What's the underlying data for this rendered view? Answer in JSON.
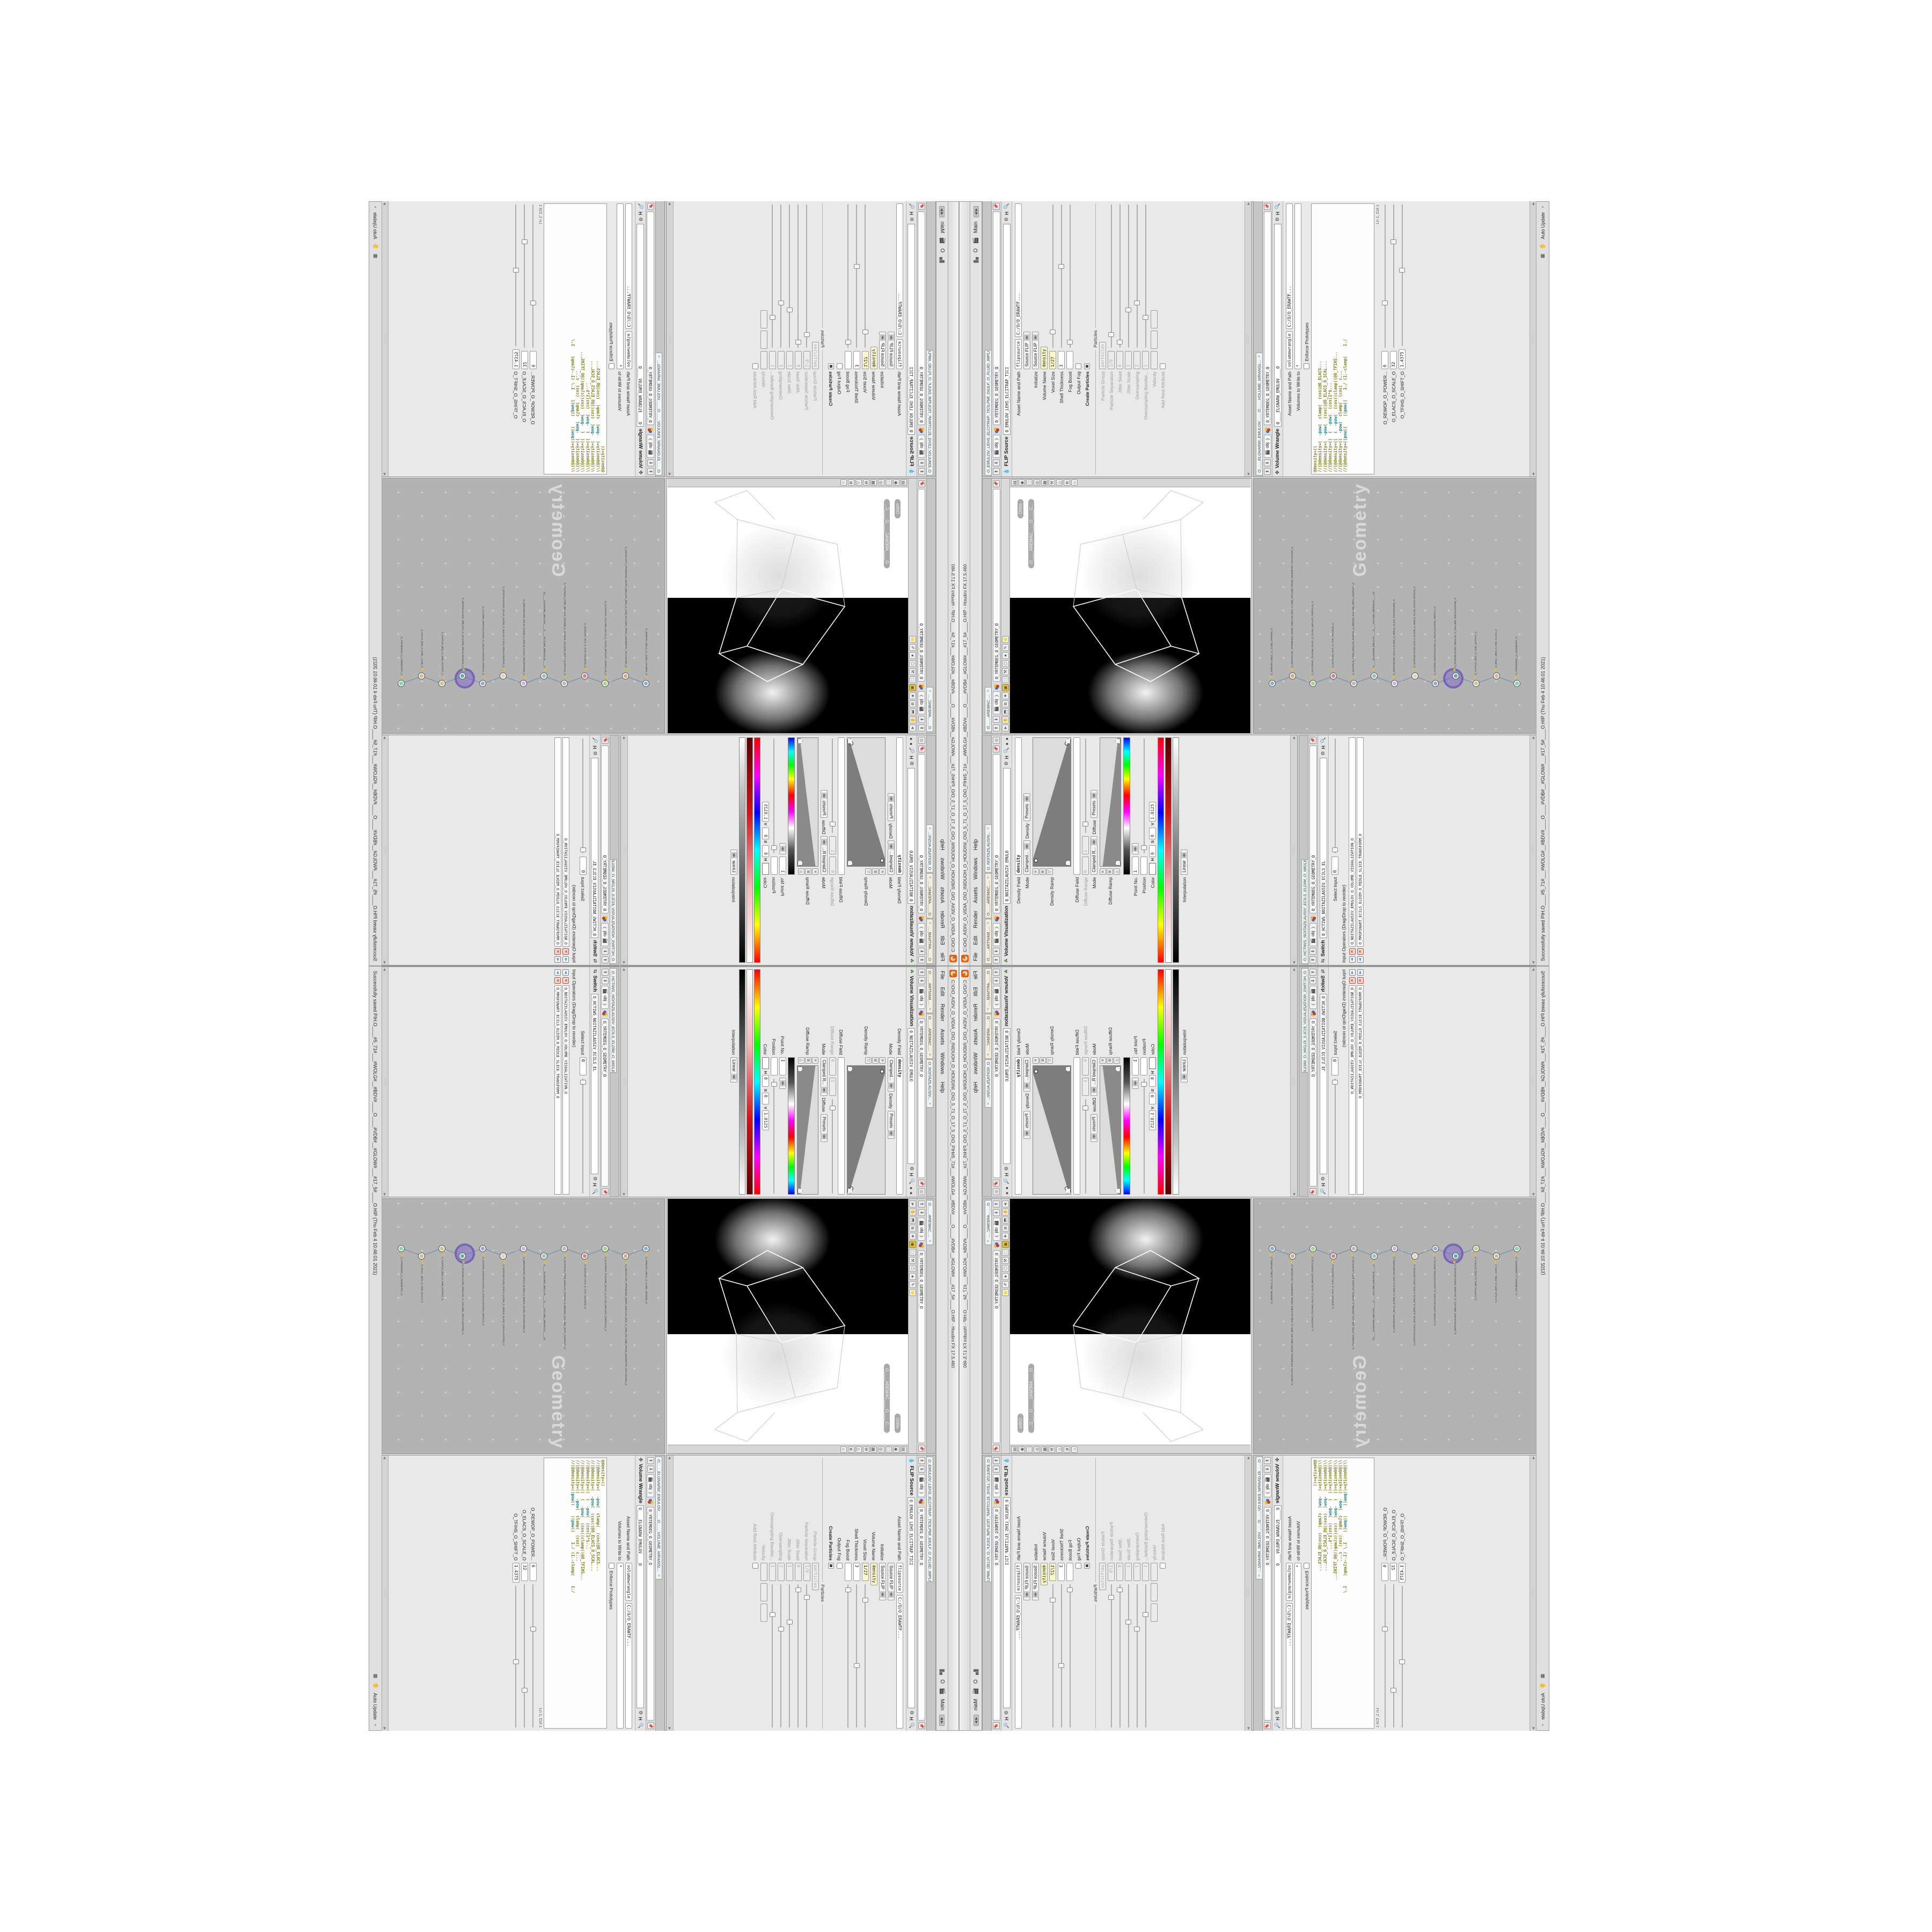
{
  "window": {
    "title": "C:\\O\\O_AIDIV_O_VIDIA_O\\O_INIDUOH_O_HOUDINI_O\\O_5_71_O_17_5_O\\O_PIH#5_71#___#WOLG#__#BDV#____O____#VDB#__#GLOW#___#17_5#____O.HIP - Houdini FX 17.5.460",
    "menus": [
      "File",
      "Edit",
      "Render",
      "Assets",
      "Windows",
      "Help"
    ],
    "menu_right_letter": "O",
    "desktop_name": "Main",
    "status_text": "Successfully saved PIH.O____#5_71#___#WOLG#__#BDV#____O____#VDB#__#GLOW#___#17_5#____O.HIP (Thu Feb 4 10:46:01 2021)",
    "auto_update_label": "Auto Update"
  },
  "colors": {
    "houdini_orange": "#e85d04",
    "selected_field_yellow": "#fbf6c8",
    "network_bg": "#b3b3b3",
    "halo_purple": "#826ec8",
    "wire_blue": "#7b93ad"
  },
  "pathbar": {
    "context": "obj",
    "node_path": "O_YRTEMOEG_O_GEOMETRY_O"
  },
  "volviz": {
    "tabs": [
      "O____ARTNAM_...",
      "O____AREMAC_...",
      "O_NOITAZILAUSIV..."
    ],
    "type": "Volume Visualization",
    "name": "O_NOITAZILAUSIV_EMULO",
    "density_field_label": "Density Field",
    "density_field_value": "density",
    "mode_label": "Mode",
    "mode_value": "Clamped...",
    "mode_mid": "Density",
    "presets_label": "Presets",
    "density_ramp_label": "Density Ramp",
    "diffuse_field_label": "Diffuse Field",
    "diffuse_range_label": "Diffuse Range",
    "diffuse_range_min": "0",
    "diffuse_range_max": "1",
    "mode2_value": "Clamped R...",
    "mode2_mid": "Diffuse",
    "diffuse_ramp_label": "Diffuse Ramp",
    "point_no_label": "Point No.",
    "point_no_value": "1",
    "position_label": "Position",
    "position_value": "",
    "color_label": "Color",
    "hsv_labels": [
      "H",
      "S",
      "V"
    ],
    "h_value": "0",
    "s_value": "0",
    "v_value": "1.8125",
    "interpolation_label": "Interpolation",
    "interpolation_value": "Linear"
  },
  "switch": {
    "tab": "O_HCTIWS_NOITAZILAUSIV_ECILS_ELDIM_O_MIDLE_SLICE_VISUAL...",
    "type": "Switch",
    "name": "O_HCTIWS_NOITAZILAUSIV_ECILS_EL",
    "select_input_label": "Select Input",
    "select_input_value": "0",
    "ops_label": "Input Operators (Drag/Drop to reorder)",
    "ops": [
      "O_NOITAZILAUSIV_EMULOV_O_VOLUME_VISUALIZATION_O",
      "O_MROFSNART_ECILS_ELDIM_O_MIDLE_SLICE_TRANSFORM_O"
    ]
  },
  "viewport": {
    "tab": "O____AREMAC_...",
    "cam_pill": "Ortho",
    "cam_pill2": "O____AREMAC____O____C...",
    "top_icons": [
      "➤",
      "✋",
      "⬒",
      "⧉",
      "✷",
      "▣",
      "⬚",
      "⚒",
      "⬡",
      "●",
      "✎",
      "⭐"
    ],
    "side_icons": [
      "▤",
      "◉",
      "⬚",
      "◎",
      "▦",
      "⚒",
      "△",
      "⧉",
      "○"
    ]
  },
  "network": {
    "watermark": "Geometry",
    "nodes": [
      {
        "label": "O_EREHPS_EBUC_O_CUBE_SPHERE_O",
        "c": "#7fb2d8"
      },
      {
        "label": "O_SNOGYLOP_YRTEMOEG_MORF_EMULOV_BDV_O_VDB_VOLUME_FROM_GEOMETRY_POLYGONS_O",
        "c": "#d8a87f"
      },
      {
        "label": "O_ELCITRAP_TICILPMI_DIULF_O_FLUID_IMPLICIT_PARTICLE_O",
        "c": "#9fd87f"
      },
      {
        "label": "O_ECRUOS_PILF_O_FLIP_SOURCE_O",
        "c": "#d87f7f"
      },
      {
        "label": "O_ECAFRUS_HTIW_EMULOV_EGREM_O_MERGE_VOLUME_WITH_SURFACE_O",
        "c": "#b8b8b8"
      },
      {
        "label": "O____ELGNARW_EMULOV____O____VOLUME_WRANGLE____O2",
        "c": "#88c7c0"
      },
      {
        "label": "O_MROFSNART_ECILS_ELDIM_O_MIDLE_SLICE_TRANSFORM_O",
        "c": "#c9b4e0"
      },
      {
        "label": "O_NOITAZILAUSIV_ECILS_ELDIM_O_MIDLE_SLICE_VISUALIZATION_O",
        "c": "#e0d4b4"
      },
      {
        "label": "O_HCTIWS_NOITAZILAUSIV_O_VISUALIZATION_SWITCH_O",
        "c": "#9aa8d0"
      },
      {
        "label": "O_NOITAZILAUSIV_EMULOV_O_VOLUME_VISUALIZATION_O",
        "c": "#53b8a4",
        "halo": true
      },
      {
        "label": "O_TUPTUO_BDV_O_VDB_OUTPUT_O",
        "c": "#caca7e"
      },
      {
        "label": "O_WOLG_BDV_O_VDB_GLOW_O",
        "c": "#e0b67f"
      },
      {
        "label": "O_YRTEMOEG_O_GEOMETRY_O",
        "c": "#7fd8a8"
      }
    ]
  },
  "flip": {
    "tab": "O_EMULOV_LEHS_ELCITRAP_TICILPMI_DIULF_O_FLUID_IMPLICIT_PARTI...",
    "type": "FLIP Source",
    "name": "O_EMULOV_LEHS_ELCITRAP_TICI",
    "asset_label": "Asset Name and Path",
    "asset_name": "flipsource",
    "asset_path": "C:/O/O_ERAWTF...",
    "preset_dd": "Source FLIP",
    "rows": [
      {
        "label": "Initialize",
        "t": "dd",
        "value": "Source FLIP"
      },
      {
        "label": "Volume Name",
        "t": "f",
        "value": "density",
        "hl": true
      },
      {
        "label": "Voxel Size",
        "t": "fs",
        "value": "1/27",
        "hl": true,
        "sp": 0.1
      },
      {
        "label": "Shell Thickness",
        "t": "fs",
        "value": "3",
        "sp": 0.55
      },
      {
        "label": "Fog Boost",
        "t": "fs",
        "value": "",
        "sp": 0.03
      },
      {
        "label": "Output Fog",
        "t": "chk",
        "on": false
      },
      {
        "label": "Create Particles",
        "t": "chk",
        "on": true,
        "bold": true
      },
      {
        "label": "Particles",
        "t": "sep"
      },
      {
        "label": "Particle Group",
        "t": "f",
        "value": "particles",
        "dis": true
      },
      {
        "label": "Particle Separation",
        "t": "fs",
        "value": "1/9",
        "dis": true,
        "sp": 0.08
      },
      {
        "label": "Jitter Seed",
        "t": "fs",
        "value": "0",
        "dis": true,
        "sp": 0.03
      },
      {
        "label": "Jitter Scale",
        "t": "fs",
        "value": "1",
        "dis": true,
        "sp": 0.25
      },
      {
        "label": "Oversampling",
        "t": "fs",
        "value": "2",
        "dis": true,
        "sp": 0.3
      },
      {
        "label": "Oversampling Bandwi...",
        "t": "fs",
        "value": "1",
        "dis": true,
        "sp": 0.2
      },
      {
        "label": "Velocity",
        "t": "vec3",
        "dis": true
      },
      {
        "label": "Add Rest Attribute",
        "t": "chk",
        "dis": true
      }
    ]
  },
  "wrangle": {
    "tab": "O____ELGNARW_EMULOV____O____VOLUME_WRANGL...",
    "type": "Volume Wrangle",
    "name": "O____ELGNARW_EMULOV____O",
    "asset_label": "Asset Name and Path",
    "asset_name": "volumewrangle",
    "asset_path": "C:/O/O_ERAWTF...",
    "volumes_label": "Volumes to Write to",
    "volumes_value": "*",
    "enforce_label": "Enforce Prototypes",
    "code_lines": [
      "@density=((",
      "//(@density=(  -pow(  clamp(  (cos(@O_ELACS...",
      "//(@density=(  -pow(  (cos((@O_ELACS_O_SCAL...",
      "//(@density=((  (  -pow(  (cos(1*$...",
      "//(@density=((  (  -pow(  (cos((clamp((@O_TFIHS...",
      "//(@density=((  -pow(  clamp(  (cos(  c...",
      "//(@density=((pow((    ((pow((    1./ (1.-clamp(    1./"
    ],
    "lncol": "Ln 1, Col 1",
    "sliders": [
      {
        "label": "O_REWOP_O_POWER...",
        "value": "6",
        "sp": 0.3
      },
      {
        "label": "O_ELACS_O_SCALE_O",
        "value": "32",
        "sp": 0.72
      },
      {
        "label": "O_TFIHS_O_SHIFT_O",
        "value": "1.4375",
        "sp": 0.52
      }
    ]
  }
}
